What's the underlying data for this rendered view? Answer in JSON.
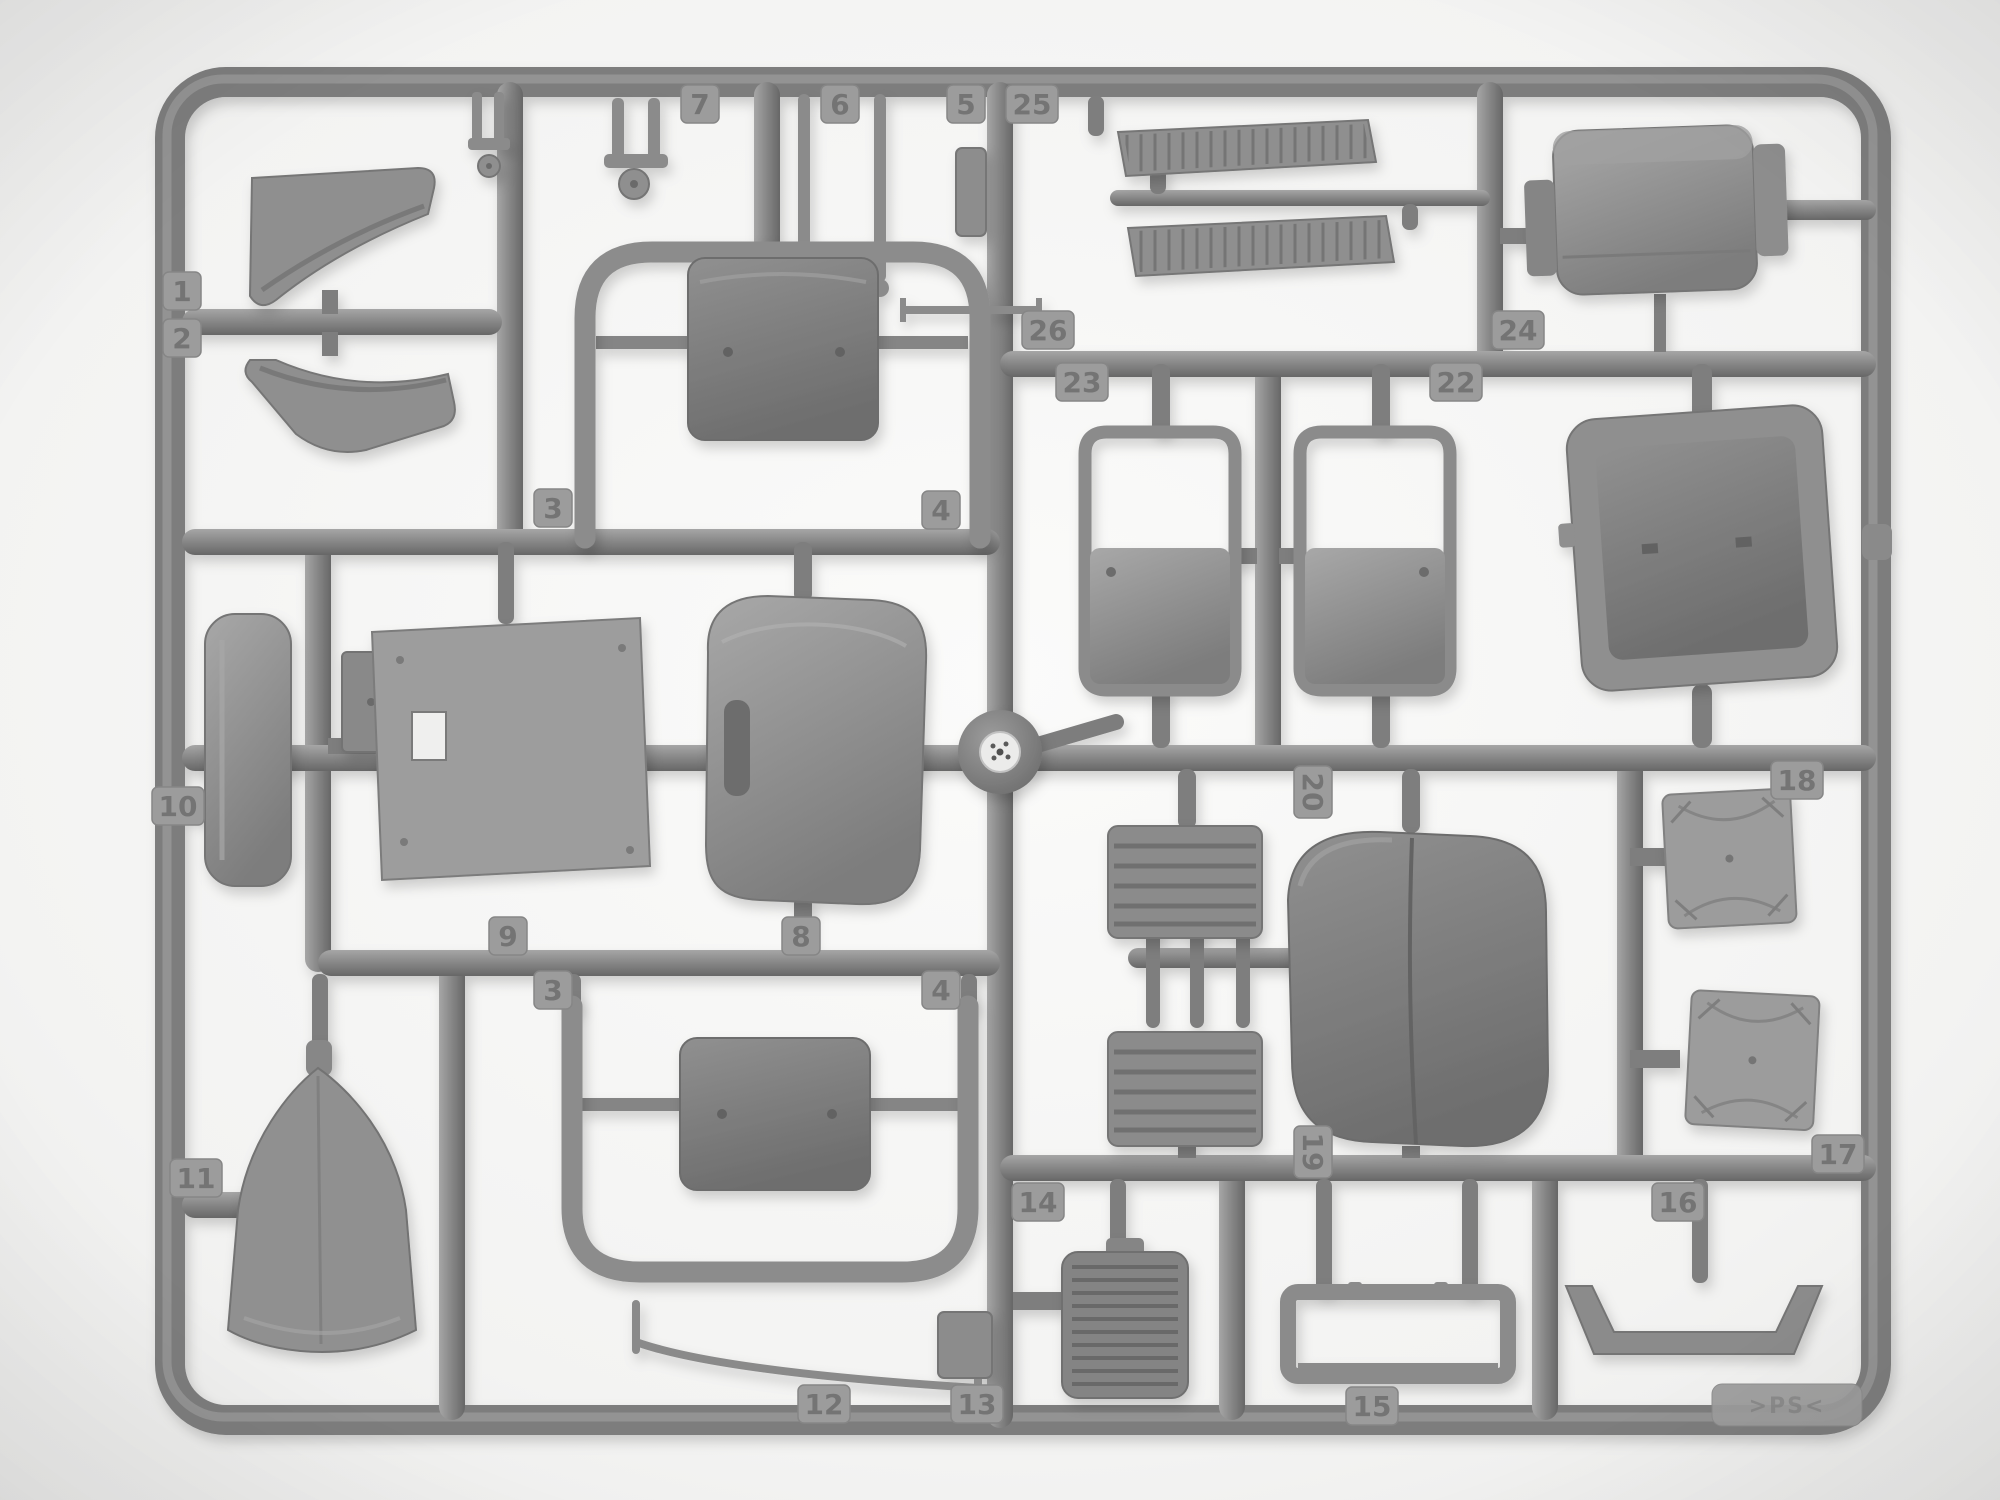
{
  "page_title": "Model kit sprue — gray styrene parts frame",
  "scene": {
    "subject": "Gray injection-molded styrene sprue with numbered automobile model parts on a white background",
    "plastic_color": "#8a8a8a",
    "runner_color": "#7b7b7b",
    "background_color": "#f2f2f1"
  },
  "material_mark": {
    "label": ">PS<"
  },
  "part_tags": [
    {
      "label": "1",
      "x": 182,
      "y": 291,
      "rot": 0
    },
    {
      "label": "2",
      "x": 182,
      "y": 338,
      "rot": 0
    },
    {
      "label": "7",
      "x": 700,
      "y": 104,
      "rot": 0
    },
    {
      "label": "6",
      "x": 840,
      "y": 104,
      "rot": 0
    },
    {
      "label": "5",
      "x": 966,
      "y": 104,
      "rot": 0
    },
    {
      "label": "25",
      "x": 1032,
      "y": 104,
      "rot": 0
    },
    {
      "label": "26",
      "x": 1048,
      "y": 330,
      "rot": 0
    },
    {
      "label": "23",
      "x": 1082,
      "y": 382,
      "rot": 0
    },
    {
      "label": "24",
      "x": 1518,
      "y": 330,
      "rot": 0
    },
    {
      "label": "22",
      "x": 1456,
      "y": 382,
      "rot": 0
    },
    {
      "label": "3",
      "x": 553,
      "y": 508,
      "rot": 0
    },
    {
      "label": "4",
      "x": 941,
      "y": 510,
      "rot": 0
    },
    {
      "label": "9",
      "x": 508,
      "y": 936,
      "rot": 0
    },
    {
      "label": "8",
      "x": 801,
      "y": 936,
      "rot": 0
    },
    {
      "label": "3",
      "x": 553,
      "y": 990,
      "rot": 0
    },
    {
      "label": "4",
      "x": 941,
      "y": 990,
      "rot": 0
    },
    {
      "label": "10",
      "x": 178,
      "y": 806,
      "rot": 0
    },
    {
      "label": "11",
      "x": 196,
      "y": 1178,
      "rot": 0
    },
    {
      "label": "20",
      "x": 1313,
      "y": 792,
      "rot": 90
    },
    {
      "label": "18",
      "x": 1797,
      "y": 780,
      "rot": 0
    },
    {
      "label": "19",
      "x": 1313,
      "y": 1152,
      "rot": 90
    },
    {
      "label": "14",
      "x": 1038,
      "y": 1202,
      "rot": 0
    },
    {
      "label": "16",
      "x": 1678,
      "y": 1202,
      "rot": 0
    },
    {
      "label": "17",
      "x": 1838,
      "y": 1154,
      "rot": 0
    },
    {
      "label": "12",
      "x": 824,
      "y": 1404,
      "rot": 0
    },
    {
      "label": "13",
      "x": 977,
      "y": 1404,
      "rot": 0
    },
    {
      "label": "15",
      "x": 1372,
      "y": 1406,
      "rot": 0
    }
  ]
}
